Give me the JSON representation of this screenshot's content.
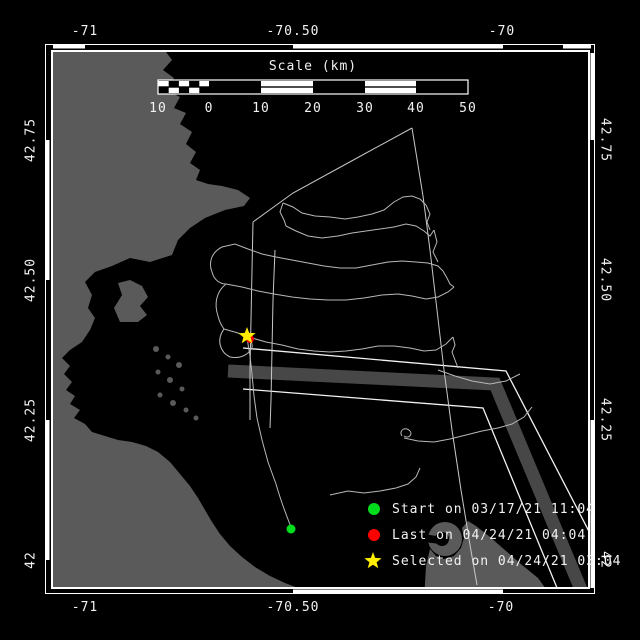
{
  "axes": {
    "top": [
      {
        "label": "-71"
      },
      {
        "label": "-70.50"
      },
      {
        "label": "-70"
      }
    ],
    "bottom": [
      {
        "label": "-71"
      },
      {
        "label": "-70.50"
      },
      {
        "label": "-70"
      }
    ],
    "left": [
      {
        "label": "42.75"
      },
      {
        "label": "42.50"
      },
      {
        "label": "42.25"
      },
      {
        "label": "42"
      }
    ],
    "right": [
      {
        "label": "42.75"
      },
      {
        "label": "42.50"
      },
      {
        "label": "42.25"
      },
      {
        "label": "42"
      }
    ]
  },
  "scalebar": {
    "title": "Scale (km)",
    "ticks": [
      {
        "label": "10"
      },
      {
        "label": "0"
      },
      {
        "label": "10"
      },
      {
        "label": "20"
      },
      {
        "label": "30"
      },
      {
        "label": "40"
      },
      {
        "label": "50"
      }
    ]
  },
  "legend": {
    "items": [
      {
        "marker": "green-circle",
        "label": "Start on 03/17/21 11:04"
      },
      {
        "marker": "red-circle",
        "label": "Last on 04/24/21 04:04"
      },
      {
        "marker": "yellow-star",
        "label": "Selected on 04/24/21 03:04"
      }
    ]
  },
  "map": {
    "colors": {
      "ocean": "#000000",
      "land": "#5a5a5a",
      "track": "#b8b8b8",
      "survey_line": "#c8c8c8",
      "tss_band": "#474747",
      "tss_line": "#f2f2f2",
      "frame": "#ffffff",
      "start_marker": "#00dd1c",
      "last_marker": "#ff0000",
      "selected_marker": "#ffee00"
    },
    "markers": {
      "start": {
        "x": 291,
        "y": 529
      },
      "last": {
        "x": 250,
        "y": 339
      },
      "selected": {
        "x": 247,
        "y": 336
      }
    }
  }
}
